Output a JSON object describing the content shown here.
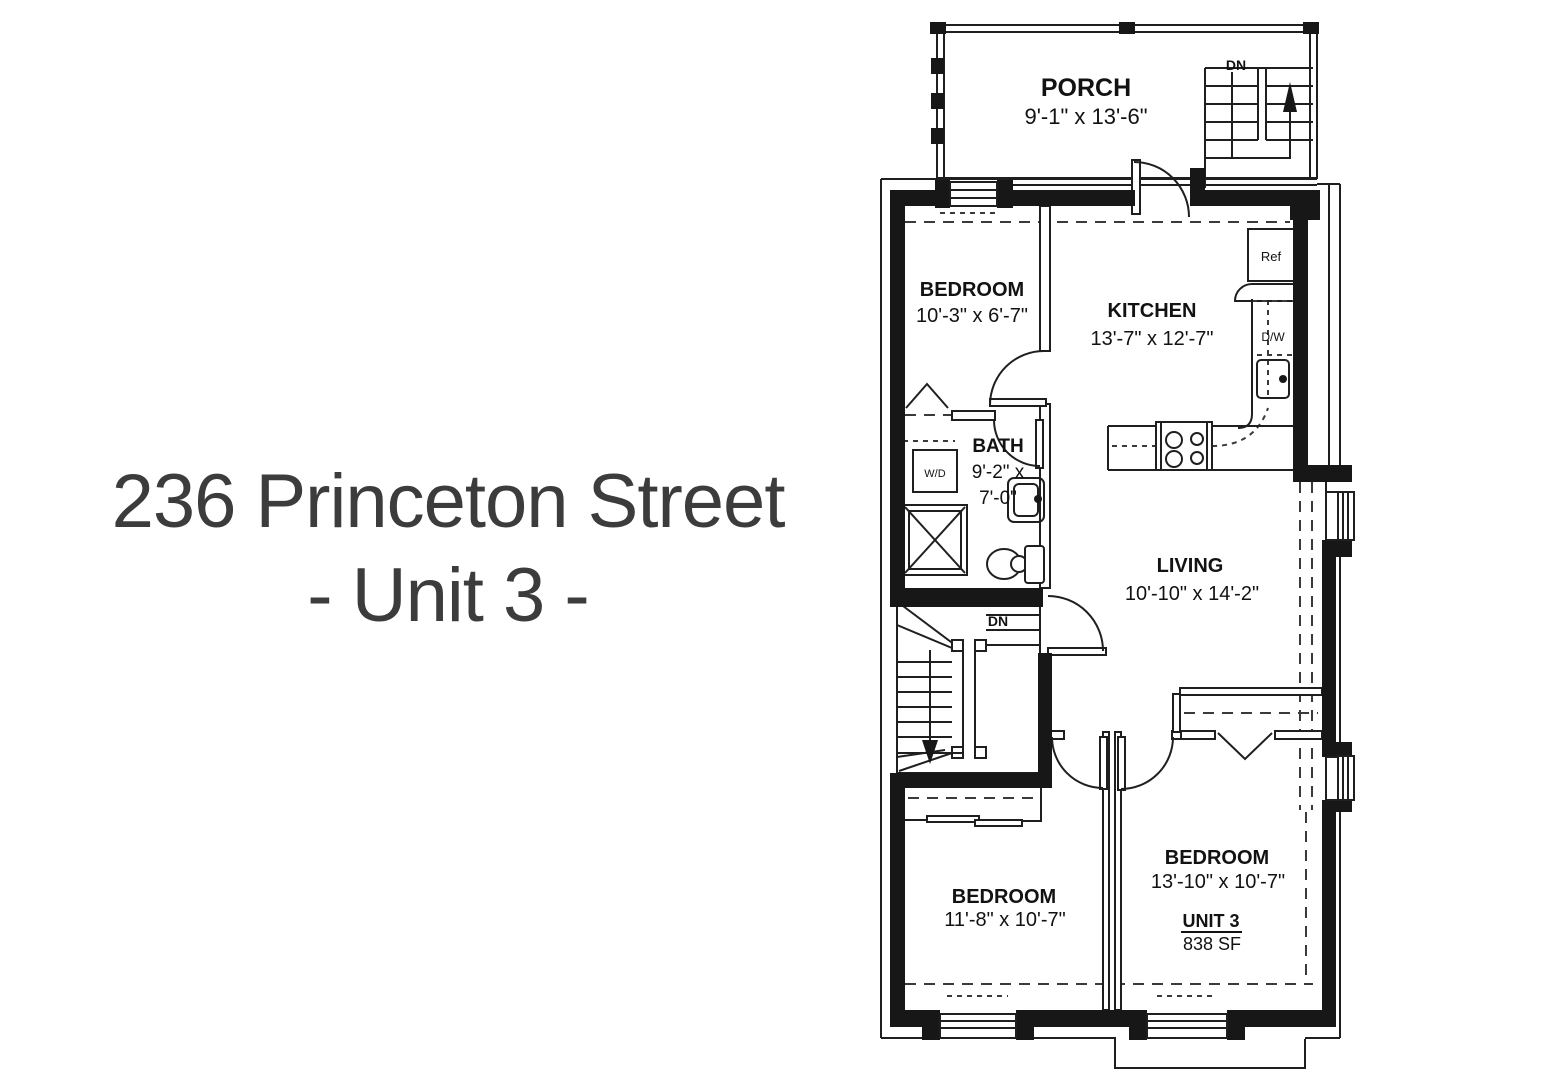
{
  "title": {
    "line1": "236 Princeton Street",
    "line2": "- Unit 3 -"
  },
  "rooms": {
    "porch": {
      "name": "PORCH",
      "dims": "9'-1\" x 13'-6\""
    },
    "bedroom_top": {
      "name": "BEDROOM",
      "dims": "10'-3\" x 6'-7\""
    },
    "kitchen": {
      "name": "KITCHEN",
      "dims": "13'-7\" x 12'-7\""
    },
    "bath": {
      "name": "BATH",
      "dims_l1": "9'-2\" x",
      "dims_l2": "7'-0\""
    },
    "living": {
      "name": "LIVING",
      "dims": "10'-10\" x 14'-2\""
    },
    "bedroom_left": {
      "name": "BEDROOM",
      "dims": "11'-8\" x 10'-7\""
    },
    "bedroom_right": {
      "name": "BEDROOM",
      "dims": "13'-10\" x 10'-7\""
    }
  },
  "unit": {
    "label": "UNIT 3",
    "area": "838 SF"
  },
  "fixtures": {
    "washer_dryer": "W/D",
    "refrigerator": "Ref",
    "dishwasher": "D/W"
  },
  "stairs": {
    "down_label": "DN"
  },
  "colors": {
    "background": "#ffffff",
    "wall": "#171717",
    "line": "#1f1f1f",
    "dashed_line": "#3a3a3a",
    "text": "#121212",
    "title_text": "#3c3c3c"
  }
}
